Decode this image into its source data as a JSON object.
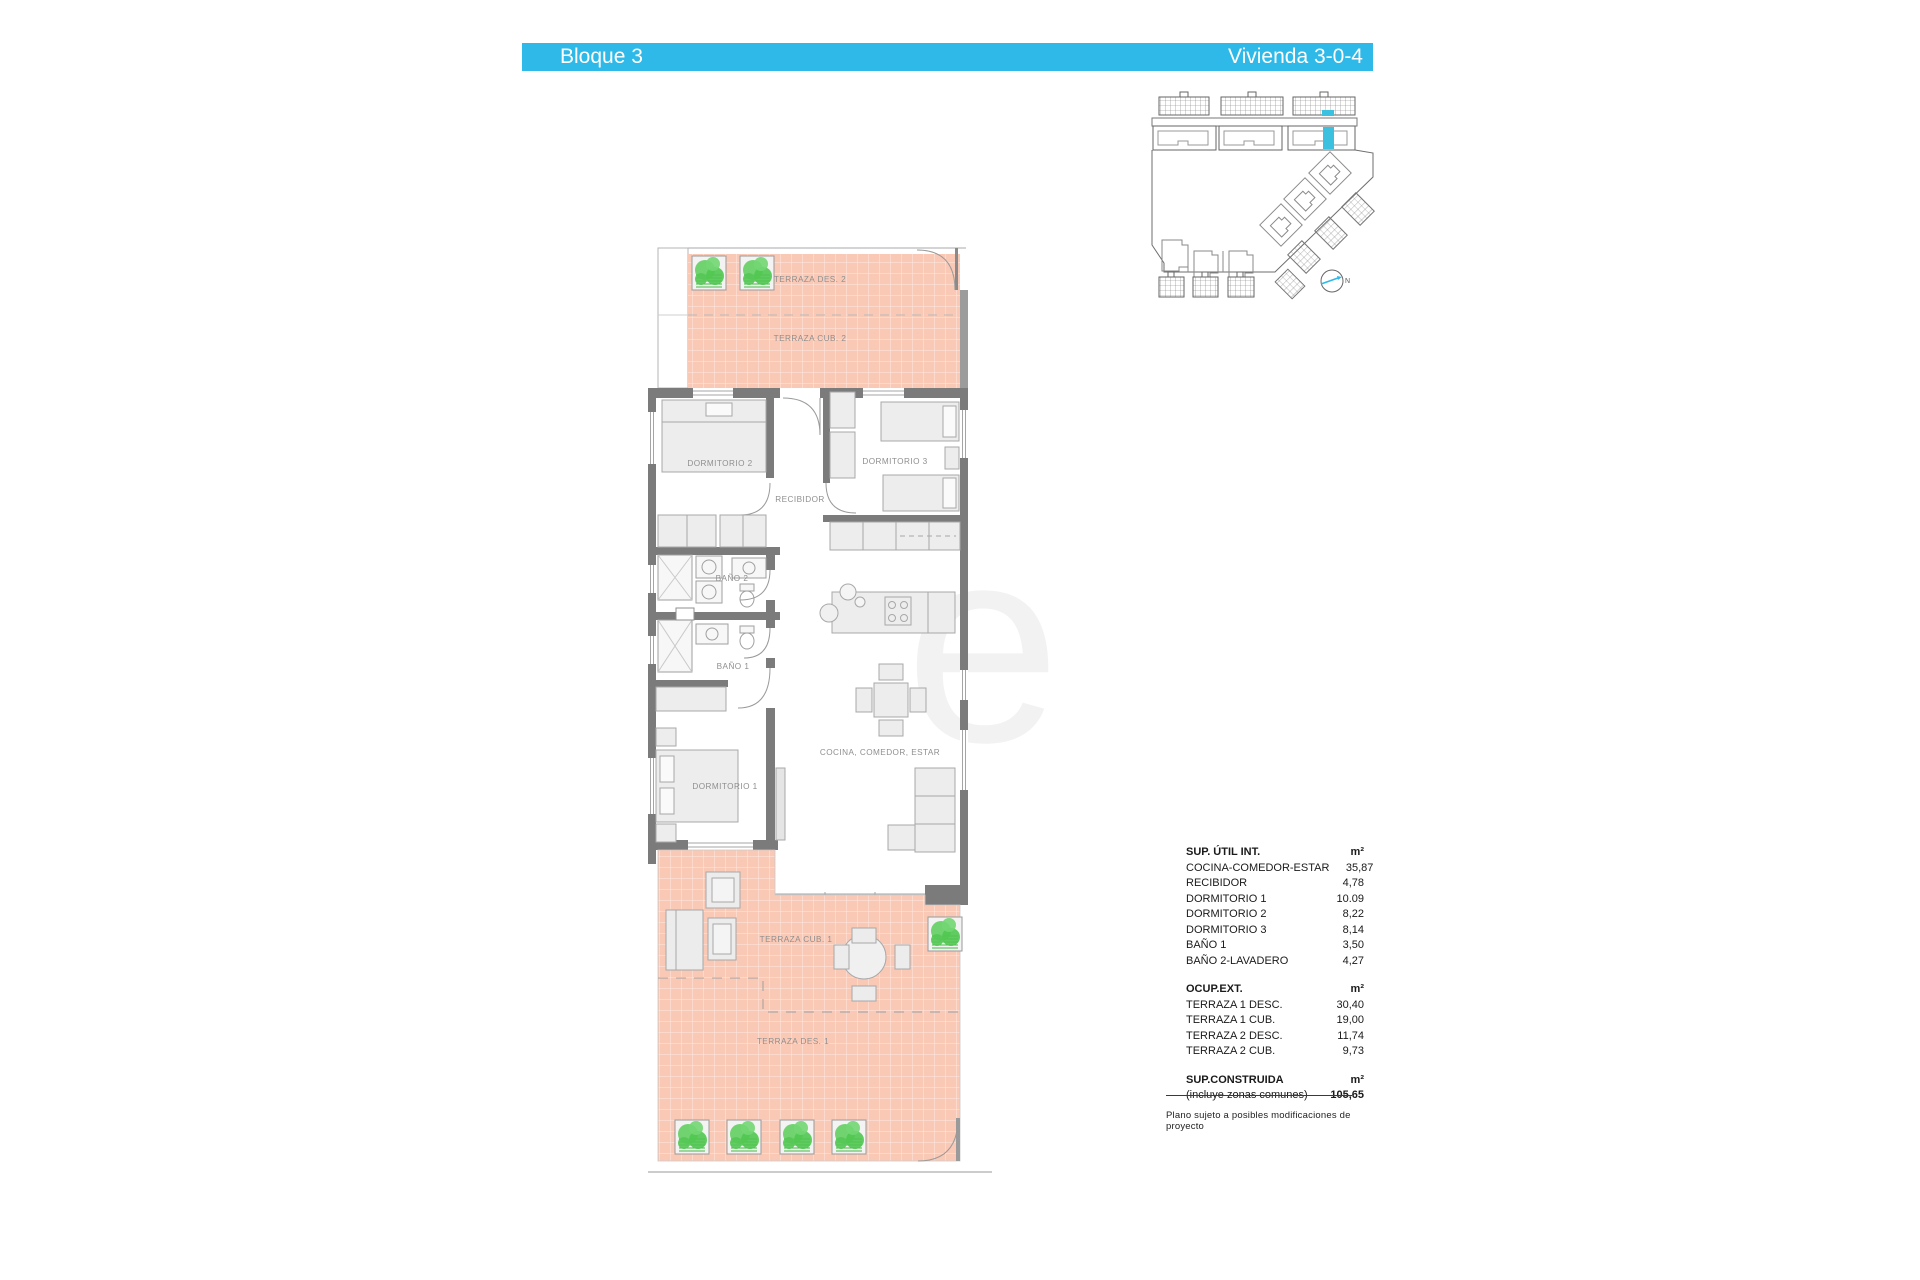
{
  "meta": {
    "accent_color": "#2FB9E8",
    "terrace_color": "#F9C9B6",
    "wall_color": "#7B7B7B",
    "plant_color": "#5BCB5B"
  },
  "header": {
    "block_label": "Bloque 3",
    "unit_label": "Vivienda 3-0-4"
  },
  "watermark": {
    "letter": "e"
  },
  "site_plan": {
    "north_label": "N"
  },
  "floor_plan": {
    "rooms": {
      "terraza_des_2": "TERRAZA DES. 2",
      "terraza_cub_2": "TERRAZA CUB. 2",
      "dormitorio_2": "DORMITORIO 2",
      "dormitorio_3": "DORMITORIO 3",
      "recibidor": "RECIBIDOR",
      "bano_2": "BAÑO 2",
      "bano_1": "BAÑO 1",
      "dormitorio_1": "DORMITORIO 1",
      "cocina_comedor_estar": "COCINA, COMEDOR, ESTAR",
      "terraza_cub_1": "TERRAZA CUB. 1",
      "terraza_des_1": "TERRAZA DES. 1"
    }
  },
  "area_table": {
    "sections": [
      {
        "title": "SUP. ÚTIL INT.",
        "unit": "m²",
        "rows": [
          {
            "label": "COCINA-COMEDOR-ESTAR",
            "value": "35,87"
          },
          {
            "label": "RECIBIDOR",
            "value": "4,78"
          },
          {
            "label": "DORMITORIO 1",
            "value": "10.09"
          },
          {
            "label": "DORMITORIO 2",
            "value": "8,22"
          },
          {
            "label": "DORMITORIO 3",
            "value": "8,14"
          },
          {
            "label": "BAÑO 1",
            "value": "3,50"
          },
          {
            "label": "BAÑO 2-LAVADERO",
            "value": "4,27"
          }
        ]
      },
      {
        "title": "OCUP.EXT.",
        "unit": "m²",
        "rows": [
          {
            "label": "TERRAZA 1 DESC.",
            "value": "30,40"
          },
          {
            "label": "TERRAZA 1 CUB.",
            "value": "19,00"
          },
          {
            "label": "TERRAZA 2 DESC.",
            "value": "11,74"
          },
          {
            "label": "TERRAZA 2 CUB.",
            "value": "9,73"
          }
        ]
      },
      {
        "title": "SUP.CONSTRUIDA",
        "unit": "m²",
        "rows": [
          {
            "label": "(incluye zonas comunes)",
            "value": "105,65",
            "bold_value": true
          }
        ]
      }
    ],
    "footnote": "Plano sujeto a posibles modificaciones de proyecto"
  }
}
